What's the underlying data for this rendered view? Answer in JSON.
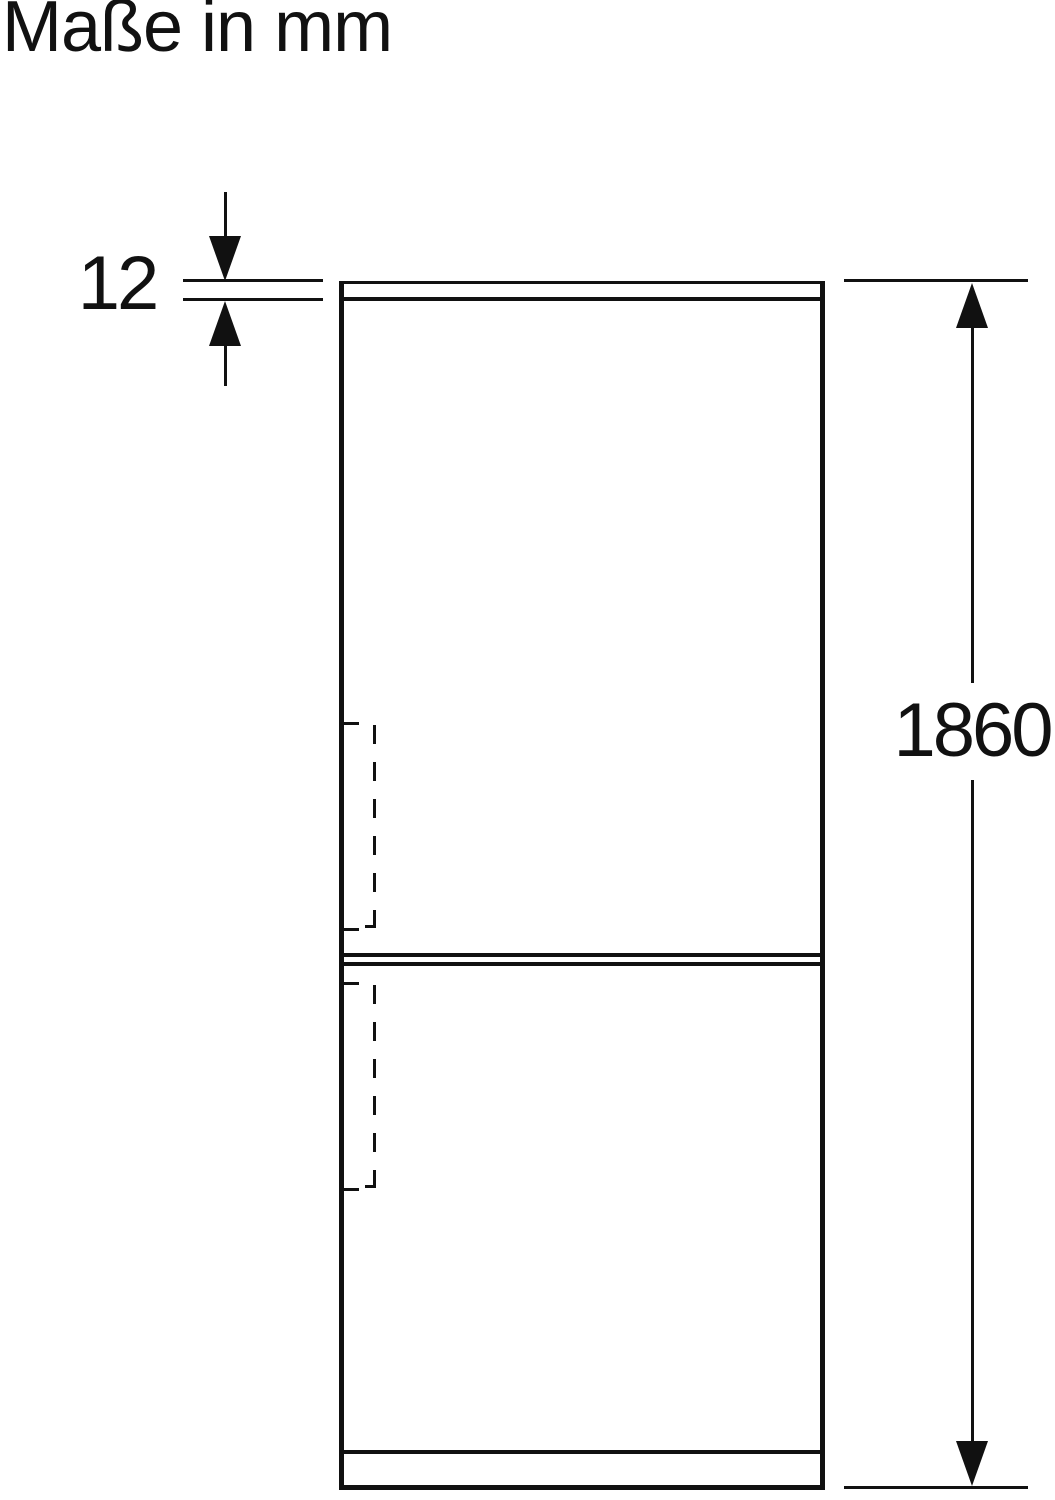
{
  "title": "Maße in mm",
  "dimensions": {
    "top_panel_thickness": "12",
    "total_height": "1860"
  },
  "icons": {
    "dim12_arrow_down": "filled-triangle-down",
    "dim12_arrow_up": "filled-triangle-up",
    "height_arrow_up": "filled-triangle-up",
    "height_arrow_down": "filled-triangle-down"
  },
  "colors": {
    "line": "#111111",
    "text": "#111111",
    "background": "#ffffff"
  }
}
